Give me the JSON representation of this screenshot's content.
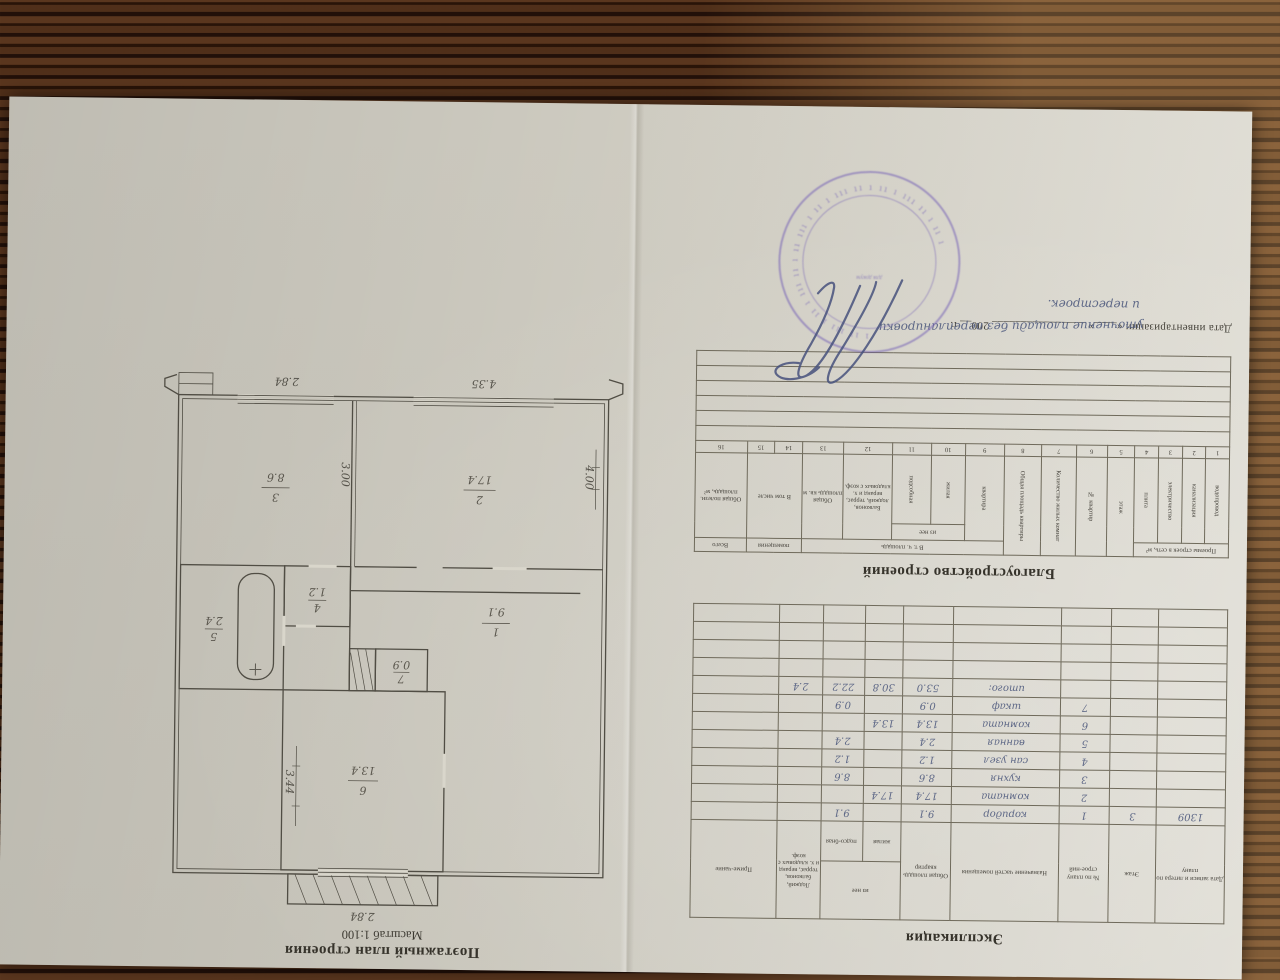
{
  "plan_block": {
    "title": "Поэтажный план строения",
    "subtitle": "Масштаб 1:100",
    "rooms": [
      {
        "num": "6",
        "area": "13.4"
      },
      {
        "num": "7",
        "area": "0.9"
      },
      {
        "num": "5",
        "area": "2.4"
      },
      {
        "num": "4",
        "area": "1.2"
      },
      {
        "num": "1",
        "area": "9.1"
      },
      {
        "num": "2",
        "area": "17.4"
      },
      {
        "num": "3",
        "area": "8.6"
      }
    ],
    "dims": {
      "room6_h": "3.44",
      "room6_w": "2.84",
      "room2_w": "4.35",
      "room2_h": "4.00",
      "kitchen_w": "2.84",
      "kitchen_h": "3.00"
    }
  },
  "explication": {
    "title": "Экспликация",
    "headers": {
      "date": "Дата записи и литера по плану",
      "floor": "Этаж",
      "num": "№ по плану строе-ний",
      "purpose": "Назначение частей помещения",
      "total": "Общая площадь квартир",
      "iznee": "из нее",
      "living": "жилая",
      "aux": "подсо-бная",
      "balc": "Лоджий, балконов, террас, веранд и х. кладовых с коэф.",
      "note": "Приме-чание"
    },
    "rows": [
      {
        "date": "1309",
        "floor": "3",
        "num": "1",
        "name": "коридор",
        "total": "9.1",
        "living": "",
        "aux": "9.1",
        "balc": ""
      },
      {
        "date": "",
        "floor": "",
        "num": "2",
        "name": "комната",
        "total": "17.4",
        "living": "17.4",
        "aux": "",
        "balc": ""
      },
      {
        "date": "",
        "floor": "",
        "num": "3",
        "name": "кухня",
        "total": "8.6",
        "living": "",
        "aux": "8.6",
        "balc": ""
      },
      {
        "date": "",
        "floor": "",
        "num": "4",
        "name": "сан узел",
        "total": "1.2",
        "living": "",
        "aux": "1.2",
        "balc": ""
      },
      {
        "date": "",
        "floor": "",
        "num": "5",
        "name": "ванная",
        "total": "2.4",
        "living": "",
        "aux": "2.4",
        "balc": ""
      },
      {
        "date": "",
        "floor": "",
        "num": "6",
        "name": "комната",
        "total": "13.4",
        "living": "13.4",
        "aux": "",
        "balc": ""
      },
      {
        "date": "",
        "floor": "",
        "num": "7",
        "name": "шкаф",
        "total": "0.9",
        "living": "",
        "aux": "0.9",
        "balc": ""
      },
      {
        "date": "",
        "floor": "",
        "num": "",
        "name": "итого:",
        "total": "53.0",
        "living": "30.8",
        "aux": "22.2",
        "balc": "2.4"
      }
    ]
  },
  "blag": {
    "title": "Благоустройство строений",
    "group_net": "Проемы строек в сеть, м²",
    "group_vtch": "В т. ч. площадь",
    "group_iznee": "из нее",
    "group_pom": "помещения",
    "group_vtom": "В том числе",
    "col16_top": "Всего",
    "col16_sub": "Общая полезн. площадь, м²",
    "cols": [
      {
        "num": "1",
        "label": "водопровод"
      },
      {
        "num": "2",
        "label": "канализация"
      },
      {
        "num": "3",
        "label": "электричество"
      },
      {
        "num": "4",
        "label": "плита"
      },
      {
        "num": "5",
        "label": "этаж"
      },
      {
        "num": "6",
        "label": "№ квартир"
      },
      {
        "num": "7",
        "label": "Количество жилых комнат"
      },
      {
        "num": "8",
        "label": "Общая площадь квартиры"
      },
      {
        "num": "9",
        "label": "квартира"
      },
      {
        "num": "10",
        "label": "жилая"
      },
      {
        "num": "11",
        "label": "подсобная"
      },
      {
        "num": "12",
        "label": "Балконов, лоджий, террас, веранд и х. кладовых с коэф."
      },
      {
        "num": "13",
        "label": "Общая площадь кв. м"
      },
      {
        "num": "14",
        "label": ""
      },
      {
        "num": "15",
        "label": ""
      },
      {
        "num": "16",
        "label": ""
      }
    ],
    "handwriting_line1": "уточнение площади без перепланировки",
    "handwriting_line2": "и перестроек.",
    "date_line": "Дата инвентаризации  «____» ________________ 200__ г."
  },
  "stamp": {
    "center_marks": "для докум",
    "arc_marks": "· ı ·"
  }
}
